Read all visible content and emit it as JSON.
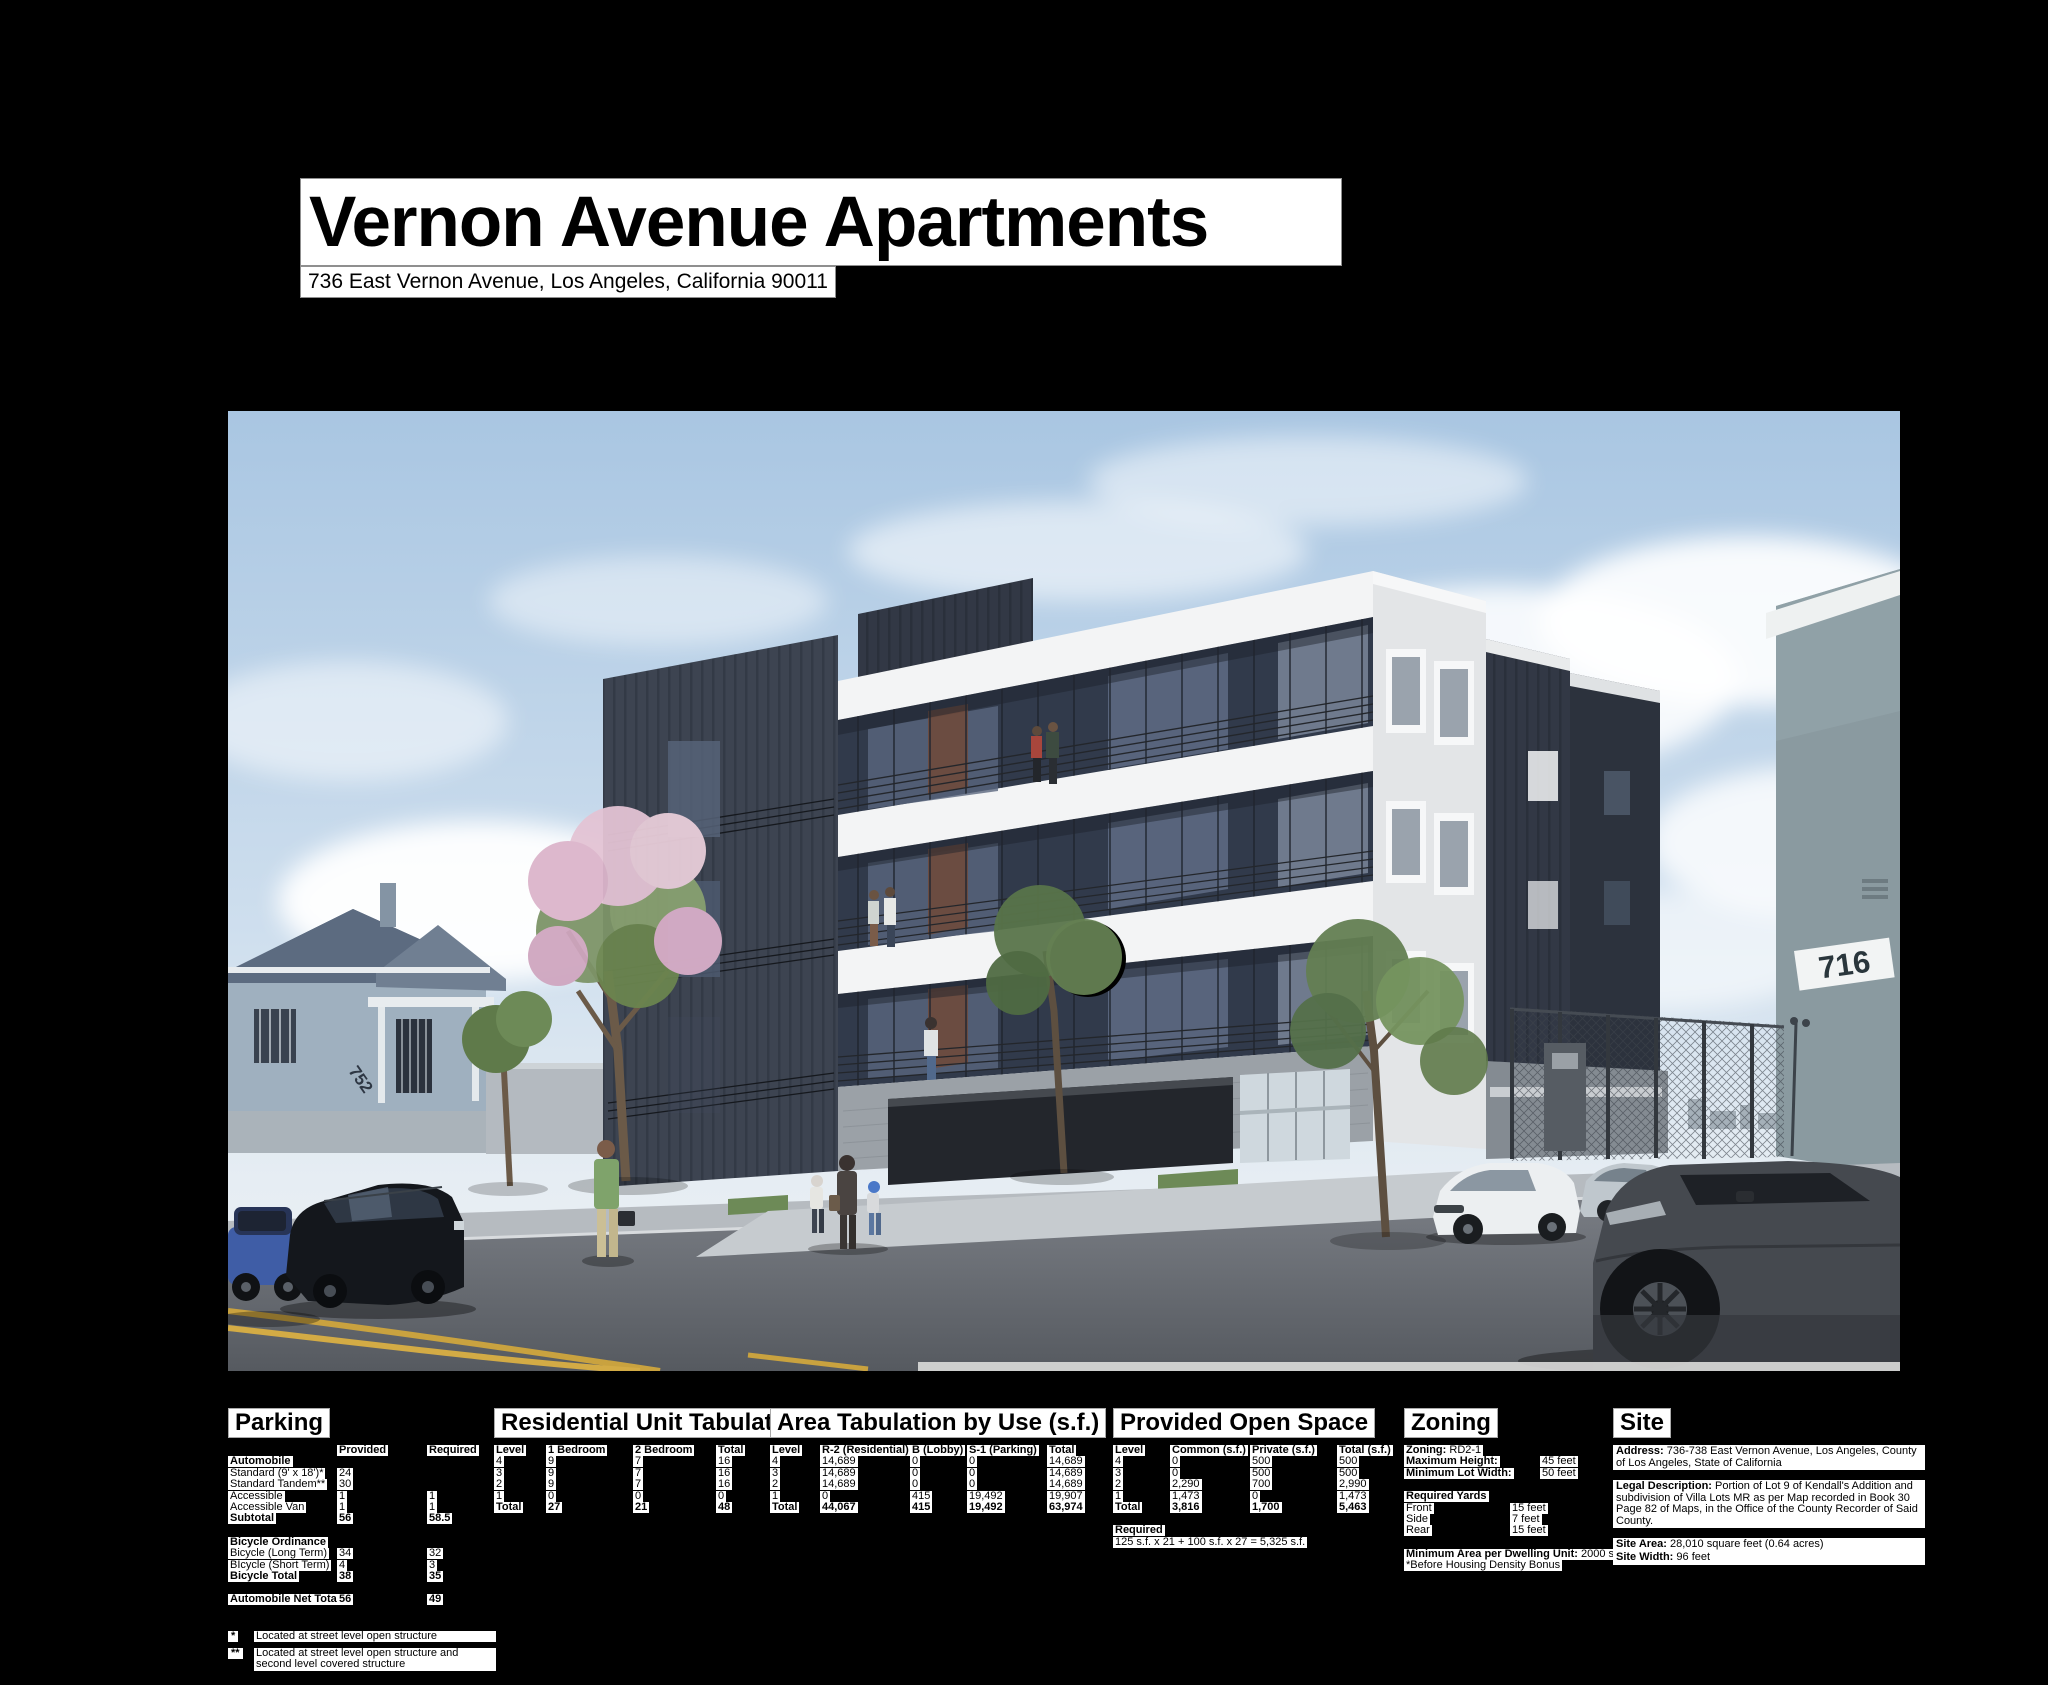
{
  "title_block": {
    "title": "Vernon Avenue Apartments",
    "address": "736 East Vernon Avenue, Los Angeles, California 90011"
  },
  "rendering": {
    "description": "Street-level rendering of a four-story apartment building with dark metal cladding, white frame, balconies, street trees, parked cars and pedestrians",
    "left_house_number": "752",
    "right_building_number": "716"
  },
  "parking": {
    "title": "Parking",
    "col_provided": "Provided",
    "col_required": "Required",
    "auto_heading": "Automobile",
    "rows_auto": [
      {
        "label": "Standard (9' x 18')*",
        "provided": "24",
        "required": ""
      },
      {
        "label": "Standard Tandem**",
        "provided": "30",
        "required": ""
      },
      {
        "label": "Accessible",
        "provided": "1",
        "required": "1"
      },
      {
        "label": "Accessible Van",
        "provided": "1",
        "required": "1"
      },
      {
        "label": "Subtotal",
        "provided": "56",
        "required": "58.5"
      }
    ],
    "bike_heading": "Bicycle Ordinance",
    "rows_bike": [
      {
        "label": "Bicycle (Long Term)",
        "provided": "34",
        "required": "32"
      },
      {
        "label": "BIcycle (Short Term)",
        "provided": "4",
        "required": "3"
      },
      {
        "label": "Bicycle Total",
        "provided": "38",
        "required": "35"
      }
    ],
    "net_total": {
      "label": "Automobile Net Total",
      "provided": "56",
      "required": "49"
    },
    "footnotes": [
      {
        "marker": "*",
        "text": "Located at street level open structure"
      },
      {
        "marker": "**",
        "text": "Located at street level open structure and second level covered structure"
      }
    ]
  },
  "residential_unit_tabulation": {
    "title": "Residential Unit Tabulation",
    "columns": [
      "Level",
      "1 Bedroom",
      "2 Bedroom",
      "Total"
    ],
    "rows": [
      [
        "4",
        "9",
        "7",
        "16"
      ],
      [
        "3",
        "9",
        "7",
        "16"
      ],
      [
        "2",
        "9",
        "7",
        "16"
      ],
      [
        "1",
        "0",
        "0",
        "0"
      ]
    ],
    "total_row": [
      "Total",
      "27",
      "21",
      "48"
    ]
  },
  "area_tabulation": {
    "title": "Area Tabulation by Use (s.f.)",
    "columns": [
      "Level",
      "R-2 (Residential)",
      "B (Lobby)",
      "S-1 (Parking)",
      "Total"
    ],
    "rows": [
      [
        "4",
        "14,689",
        "0",
        "0",
        "14,689"
      ],
      [
        "3",
        "14,689",
        "0",
        "0",
        "14,689"
      ],
      [
        "2",
        "14,689",
        "0",
        "0",
        "14,689"
      ],
      [
        "1",
        "0",
        "415",
        "19,492",
        "19,907"
      ]
    ],
    "total_row": [
      "Total",
      "44,067",
      "415",
      "19,492",
      "63,974"
    ]
  },
  "provided_open_space": {
    "title": "Provided Open Space",
    "columns": [
      "Level",
      "Common (s.f.)",
      "Private (s.f.)",
      "Total (s.f.)"
    ],
    "rows": [
      [
        "4",
        "0",
        "500",
        "500"
      ],
      [
        "3",
        "0",
        "500",
        "500"
      ],
      [
        "2",
        "2,290",
        "700",
        "2,990"
      ],
      [
        "1",
        "1,473",
        "0",
        "1,473"
      ]
    ],
    "total_row": [
      "Total",
      "3,816",
      "1,700",
      "5,463"
    ],
    "required_heading": "Required",
    "required_formula": "125 s.f. x 21 + 100 s.f. x 27 = 5,325 s.f."
  },
  "zoning": {
    "title": "Zoning",
    "zoning_label": "Zoning:",
    "zoning_value": "RD2-1",
    "max_height_label": "Maximum Height:",
    "max_height_value": "45 feet",
    "min_lot_width_label": "Minimum Lot Width:",
    "min_lot_width_value": "50 feet",
    "required_yards_heading": "Required Yards",
    "yards": [
      {
        "label": "Front",
        "value": "15 feet"
      },
      {
        "label": "Side",
        "value": "7 feet"
      },
      {
        "label": "Rear",
        "value": "15 feet"
      }
    ],
    "min_area_label": "Minimum Area per Dwelling Unit:",
    "min_area_value": "2000 s.f.*",
    "min_area_note": "*Before Housing Density Bonus"
  },
  "site": {
    "title": "Site",
    "address_label": "Address:",
    "address_value": "736-738 East Vernon Avenue, Los Angeles, County of Los Angeles, State of California",
    "legal_label": "Legal Description:",
    "legal_value": "Portion of Lot 9 of Kendall's Addition and subdivision of Villa Lots MR as per Map recorded in Book 30 Page 82 of Maps, in the Office of the County Recorder of Said County.",
    "site_area_label": "Site Area:",
    "site_area_value": "28,010 square feet (0.64 acres)",
    "site_width_label": "Site Width:",
    "site_width_value": "96 feet"
  }
}
